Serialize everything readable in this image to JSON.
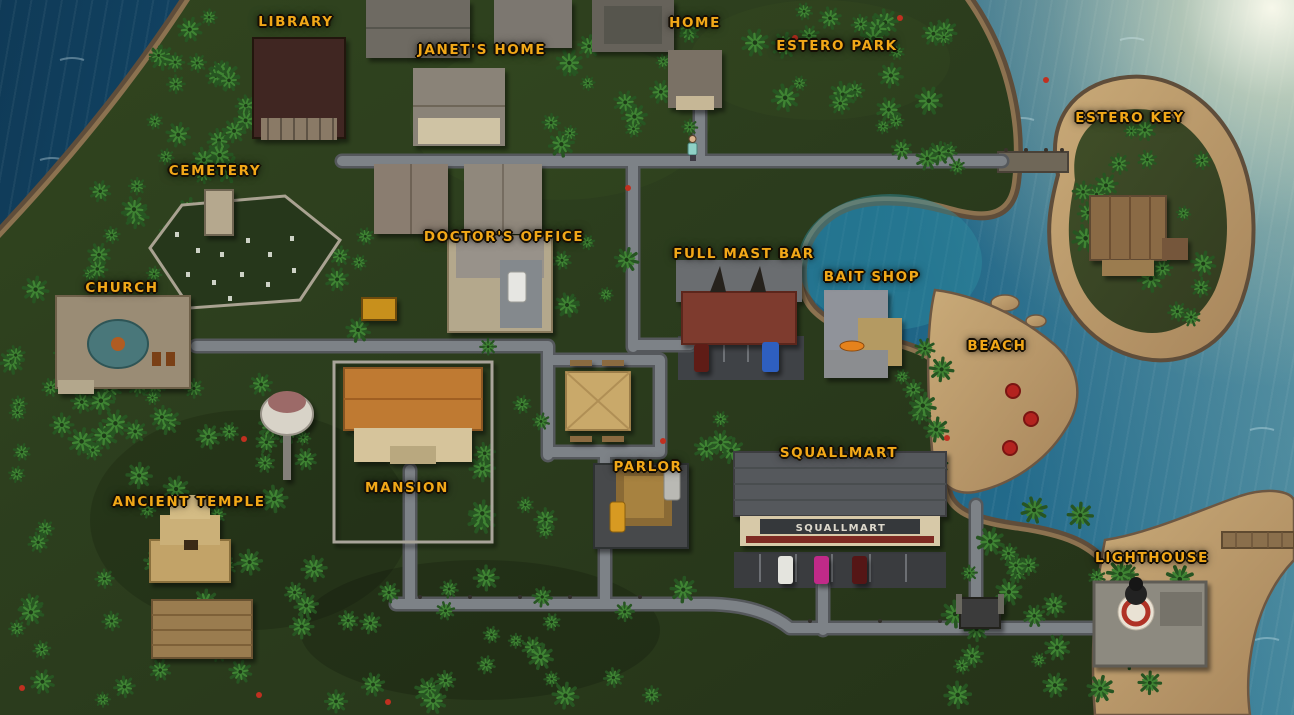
{
  "map": {
    "locations": [
      {
        "id": "library",
        "label": "LIBRARY"
      },
      {
        "id": "janets-home",
        "label": "JANET'S HOME"
      },
      {
        "id": "home",
        "label": "HOME"
      },
      {
        "id": "estero-park",
        "label": "ESTERO PARK"
      },
      {
        "id": "estero-key",
        "label": "ESTERO KEY"
      },
      {
        "id": "cemetery",
        "label": "CEMETERY"
      },
      {
        "id": "doctors-office",
        "label": "DOCTOR'S OFFICE"
      },
      {
        "id": "full-mast-bar",
        "label": "FULL MAST BAR"
      },
      {
        "id": "bait-shop",
        "label": "BAIT SHOP"
      },
      {
        "id": "beach",
        "label": "BEACH"
      },
      {
        "id": "church",
        "label": "CHURCH"
      },
      {
        "id": "mansion",
        "label": "MANSION"
      },
      {
        "id": "ancient-temple",
        "label": "ANCIENT TEMPLE"
      },
      {
        "id": "parlor",
        "label": "PARLOR"
      },
      {
        "id": "squallmart",
        "label": "SQUALLMART"
      },
      {
        "id": "lighthouse",
        "label": "LIGHTHOUSE"
      }
    ],
    "signs": {
      "squallmart_storefront": "SQUALLMART"
    },
    "colors": {
      "label_gold": "#F2A818",
      "ocean_deep": "#0F3A57",
      "ocean_light": "#2B7795",
      "jungle_green": "#2C3D20",
      "road_gray": "#7D8287",
      "sand": "#C2A272",
      "coast_rock": "#5F4D3A",
      "umbrella_red": "#B3231F"
    }
  }
}
